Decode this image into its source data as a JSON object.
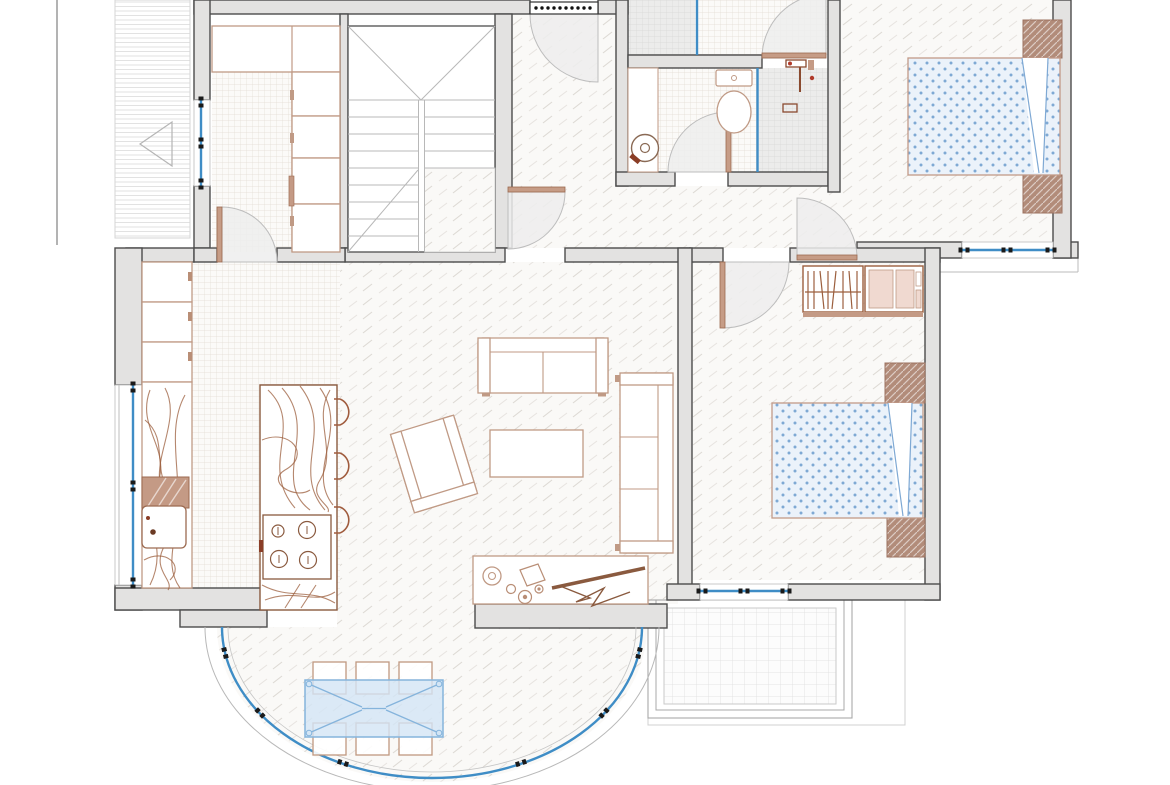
{
  "title": "apartment-floor-plan",
  "drawing_type": "architectural top-down floor plan, no text labels visible",
  "colors": {
    "wall_fill": "#e3e2e1",
    "wall_stroke": "#4c4c4c",
    "furniture": "#9c5f3e",
    "furniture_light": "#c09a85",
    "window_blue": "#3f8dc6",
    "glass_fill": "#d3e5f5",
    "glass_stroke": "#85b4dc",
    "bed_fill": "#ebf2fa",
    "bed_dot": "#7fa9d4",
    "bed_stroke": "#c29a88",
    "nightstand": "#b28c7a",
    "pink_fill": "#f0d9d0",
    "fan_fill": "#ededed",
    "fan_stroke": "#bdbdbd",
    "door_leaf": "#c69c86",
    "tile_line": "#e3dcd4",
    "plank_line": "#ddd9d4",
    "shower_fill": "#ececeb",
    "balcony_grid": "#dedede",
    "site_line": "#9a9a9a",
    "mat_dot": "#111111"
  },
  "rooms": [
    {
      "id": "walk-in-closet",
      "floor": "small grid tile",
      "position": "top-left"
    },
    {
      "id": "staircase",
      "floor": "white with treads",
      "position": "top-center-left"
    },
    {
      "id": "entry-hall",
      "floor": "wood plank",
      "position": "top-center"
    },
    {
      "id": "wc-shower",
      "floor": "grid tile + gray shower tile",
      "position": "top, above bathroom"
    },
    {
      "id": "bathroom",
      "floor": "grid tile + gray shower tile",
      "position": "center-top"
    },
    {
      "id": "bedroom-1",
      "floor": "wood plank",
      "position": "top-right"
    },
    {
      "id": "bedroom-2",
      "floor": "wood plank",
      "position": "middle-right"
    },
    {
      "id": "kitchen",
      "floor": "small grid tile",
      "position": "left"
    },
    {
      "id": "living-room",
      "floor": "wood plank",
      "position": "center"
    },
    {
      "id": "terrace",
      "floor": "wood plank",
      "position": "bottom, semicircular glazed bay"
    },
    {
      "id": "balcony",
      "floor": "large grid tile",
      "position": "bottom-right"
    },
    {
      "id": "exterior-walkway",
      "floor": "horizontal stripes with direction arrow",
      "position": "far left"
    }
  ],
  "furniture": {
    "walk_in_closet": [
      "top-cabinet",
      "shelf-compartments",
      "window"
    ],
    "entry_hall": [
      "entry-door-with-mat"
    ],
    "bathroom": [
      "vanity-counter",
      "round-washer-sink",
      "toilet",
      "glass-partition",
      "shower-fixtures"
    ],
    "wc_shower": [
      "glass-partition",
      "door"
    ],
    "bedroom_1": [
      "double-bed-blue-dotted",
      "nightstand",
      "nightstand",
      "window"
    ],
    "bedroom_2": [
      "double-bed-blue-dotted",
      "nightstand",
      "nightstand",
      "open-wardrobe-with-hangers",
      "dresser",
      "window"
    ],
    "kitchen": [
      "tall-cabinets",
      "counter-with-sink",
      "dish-rack",
      "island-with-cooktop",
      "bar-stool",
      "bar-stool",
      "bar-stool",
      "window",
      "decor-swirls"
    ],
    "living_room": [
      "two-seat-sofa",
      "three-seat-sofa",
      "armchair",
      "coffee-table",
      "tv-console",
      "tv-on-bracket",
      "decor-items"
    ],
    "terrace": [
      "glass-dining-table",
      "chair",
      "chair",
      "chair",
      "chair",
      "chair",
      "chair",
      "curved-glazing"
    ]
  },
  "openings": {
    "windows": [
      "closet-left",
      "kitchen-left",
      "bedroom-1-bottom",
      "bedroom-2-bottom",
      "terrace-curved-glazing"
    ],
    "doors": [
      "entry-top",
      "closet-to-kitchen",
      "hall-to-living",
      "bathroom",
      "wc",
      "bedroom-1",
      "bedroom-2"
    ]
  },
  "counts": {
    "terrace_chairs": 6,
    "bar_stools": 3,
    "cooktop_burners": 4,
    "beds": 2,
    "nightstands": 4
  }
}
